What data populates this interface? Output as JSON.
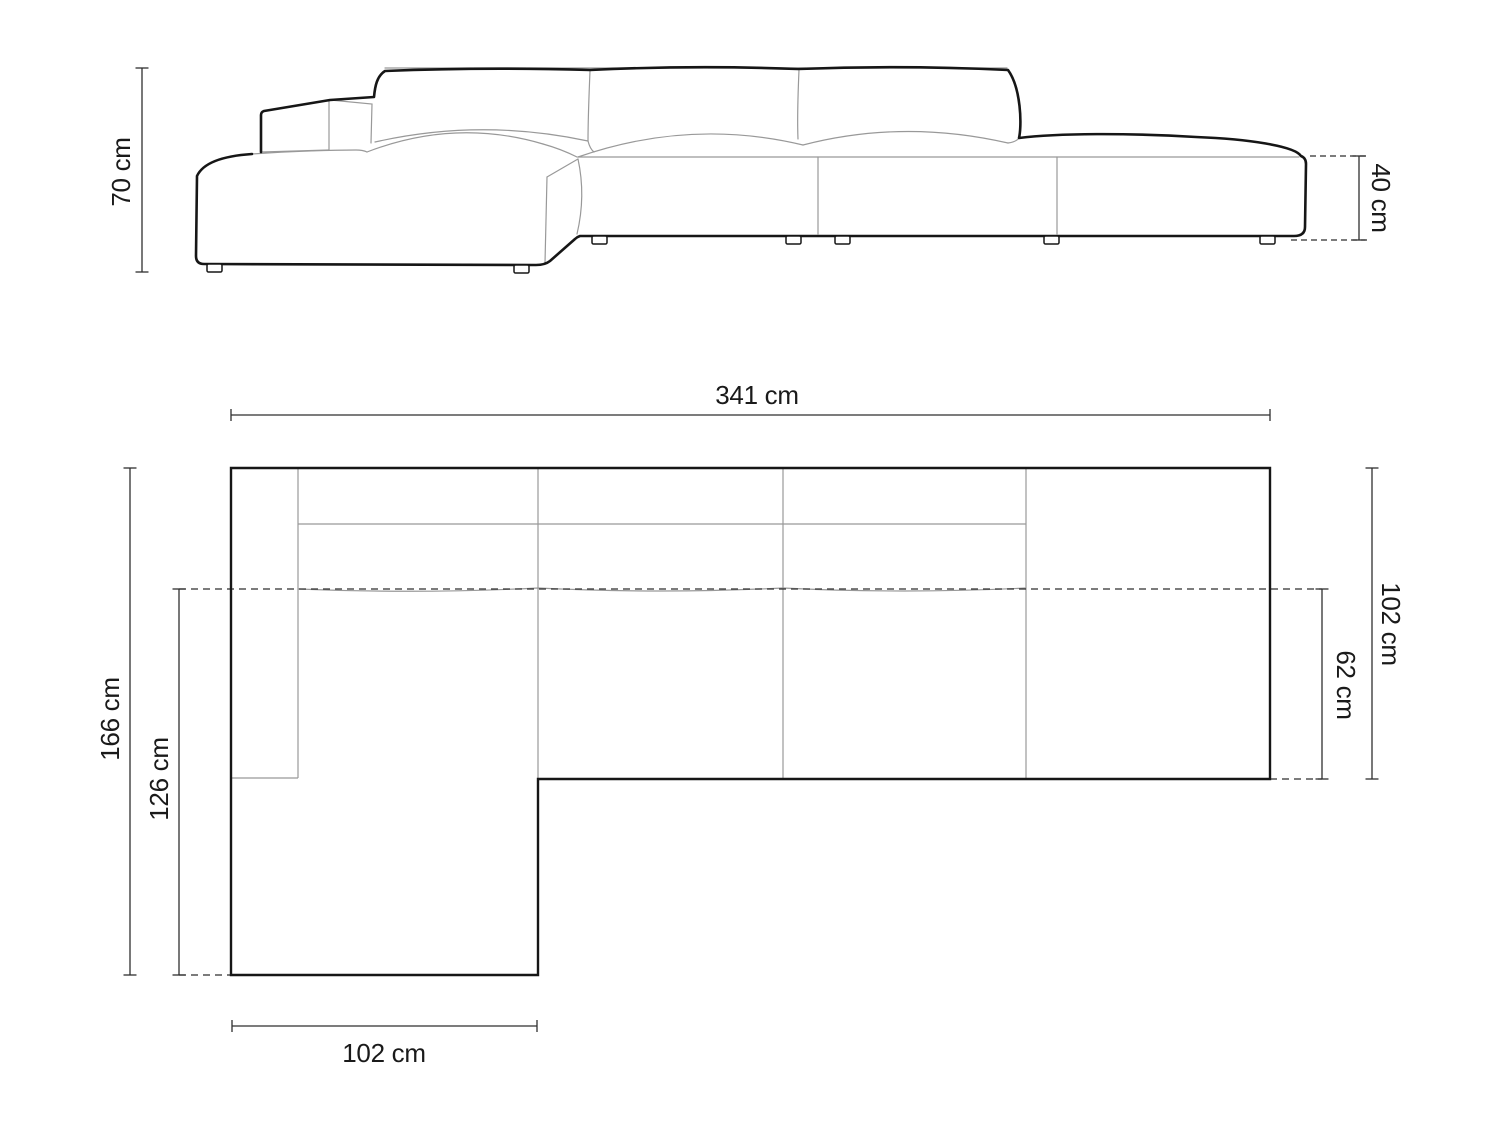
{
  "units": "cm",
  "colors": {
    "background": "#ffffff",
    "outline": "#161616",
    "interior_line": "#999999",
    "dimension_line": "#2f2f2f",
    "label": "#1a1a1a"
  },
  "front_view": {
    "dimensions": {
      "total_height": {
        "value": 70,
        "label": "70 cm"
      },
      "seat_height": {
        "value": 40,
        "label": "40 cm"
      }
    }
  },
  "plan_view": {
    "dimensions": {
      "total_width": {
        "value": 341,
        "label": "341 cm"
      },
      "total_depth": {
        "value": 166,
        "label": "166 cm"
      },
      "chaise_depth": {
        "value": 126,
        "label": "126 cm"
      },
      "chaise_width": {
        "value": 102,
        "label": "102 cm"
      },
      "body_depth": {
        "value": 102,
        "label": "102 cm"
      },
      "seat_depth": {
        "value": 62,
        "label": "62 cm"
      }
    }
  }
}
